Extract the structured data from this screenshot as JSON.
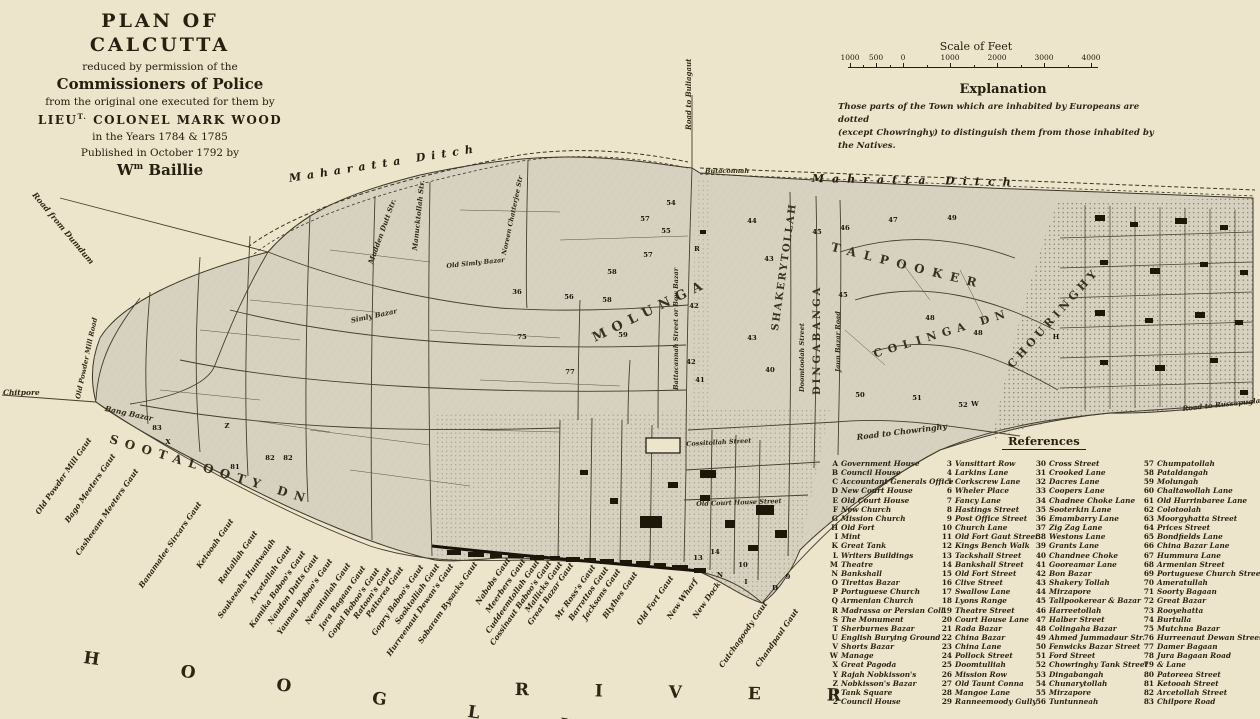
{
  "page": {
    "background": "#ece4cb",
    "ink": "#25200f",
    "land": "#d7d2c0",
    "building": "#1c1709"
  },
  "title_block": {
    "line1": "PLAN OF CALCUTTA",
    "line2": "reduced by permission of the",
    "line3": "Commissioners of Police",
    "line4": "from the original one executed for them by",
    "line5_pre": "LIEU",
    "line5_sup": "T.",
    "line5_post": " COLONEL MARK WOOD",
    "line6": "in the Years 1784 & 1785",
    "line7": "Published in October 1792 by",
    "line8_pre": "W",
    "line8_sup": "m",
    "line8_post": " Baillie"
  },
  "scale_bar": {
    "title": "Scale of Feet",
    "tick_labels": [
      "1000",
      "500",
      "0",
      "1000",
      "2000",
      "3000",
      "4000"
    ]
  },
  "explanation": {
    "heading": "Explanation",
    "line1": "Those parts of the Town which are inhabited by Europeans are dotted",
    "line2": "(except Chowringhy) to distinguish them from those inhabited by the Natives."
  },
  "references": {
    "heading": "References",
    "columns": [
      [
        [
          "A",
          "Government House"
        ],
        [
          "B",
          "Council House"
        ],
        [
          "C",
          "Accountant Generals Office"
        ],
        [
          "D",
          "New Court House"
        ],
        [
          "E",
          "Old Court House"
        ],
        [
          "F",
          "New Church"
        ],
        [
          "G",
          "Mission Church"
        ],
        [
          "H",
          "Old Fort"
        ],
        [
          "I",
          "Mint"
        ],
        [
          "K",
          "Great Tank"
        ],
        [
          "L",
          "Writers Buildings"
        ],
        [
          "M",
          "Theatre"
        ],
        [
          "N",
          "Bankshall"
        ],
        [
          "O",
          "Tirettas Bazar"
        ],
        [
          "P",
          "Portuguese Church"
        ],
        [
          "Q",
          "Armenian Church"
        ],
        [
          "R",
          "Madrassa or Persian Coll."
        ],
        [
          "S",
          "The Monument"
        ],
        [
          "T",
          "Sherburnes Bazar"
        ],
        [
          "U",
          "English Burying Ground"
        ],
        [
          "V",
          "Shorts Bazar"
        ],
        [
          "W",
          "Manage"
        ],
        [
          "X",
          "Great Pagoda"
        ],
        [
          "Y",
          "Rajah Nobkisson's"
        ],
        [
          "Z",
          "Nobkisson's Bazar"
        ],
        [
          "1",
          "Tank Square"
        ],
        [
          "2",
          "Council House"
        ]
      ],
      [
        [
          "3",
          "Vansittart Row"
        ],
        [
          "4",
          "Larkins Lane"
        ],
        [
          "5",
          "Corkscrew Lane"
        ],
        [
          "6",
          "Wheler Place"
        ],
        [
          "7",
          "Fancy Lane"
        ],
        [
          "8",
          "Hastings Street"
        ],
        [
          "9",
          "Post Office Street"
        ],
        [
          "10",
          "Church Lane"
        ],
        [
          "11",
          "Old Fort Gaut Street"
        ],
        [
          "12",
          "Kings Bench Walk"
        ],
        [
          "13",
          "Tackshall Street"
        ],
        [
          "14",
          "Bankshall Street"
        ],
        [
          "15",
          "Old Fort Street"
        ],
        [
          "16",
          "Clive Street"
        ],
        [
          "17",
          "Swallow Lane"
        ],
        [
          "18",
          "Lyons Range"
        ],
        [
          "19",
          "Theatre Street"
        ],
        [
          "20",
          "Court House Lane"
        ],
        [
          "21",
          "Rada Bazar"
        ],
        [
          "22",
          "China Bazar"
        ],
        [
          "23",
          "China Lane"
        ],
        [
          "24",
          "Pollock Street"
        ],
        [
          "25",
          "Doomtulliah"
        ],
        [
          "26",
          "Mission Row"
        ],
        [
          "27",
          "Old Taunt Conna"
        ],
        [
          "28",
          "Mangoe Lane"
        ],
        [
          "29",
          "Ranneemoody Gully"
        ]
      ],
      [
        [
          "30",
          "Cross Street"
        ],
        [
          "31",
          "Crooked Lane"
        ],
        [
          "32",
          "Dacres Lane"
        ],
        [
          "33",
          "Coopers Lane"
        ],
        [
          "34",
          "Chadnee Choke Lane"
        ],
        [
          "35",
          "Sooterkin Lane"
        ],
        [
          "36",
          "Emambarry Lane"
        ],
        [
          "37",
          "Zig Zag Lane"
        ],
        [
          "38",
          "Westons Lane"
        ],
        [
          "39",
          "Grants Lane"
        ],
        [
          "40",
          "Chandnee Choke"
        ],
        [
          "41",
          "Gooreamar Lane"
        ],
        [
          "42",
          "Bon Bazar"
        ],
        [
          "43",
          "Shakery Tollah"
        ],
        [
          "44",
          "Mirzapore"
        ],
        [
          "45",
          "Tallpookerear & Bazar"
        ],
        [
          "46",
          "Harreetollah"
        ],
        [
          "47",
          "Halber Street"
        ],
        [
          "48",
          "Colingaha Bazar"
        ],
        [
          "49",
          "Ahmed Jummadaur Str."
        ],
        [
          "50",
          "Fenwicks Bazar Street"
        ],
        [
          "51",
          "Ford Street"
        ],
        [
          "52",
          "Chowringhy Tank Street"
        ],
        [
          "53",
          "Dingabangah"
        ],
        [
          "54",
          "Chunarytollah"
        ],
        [
          "55",
          "Mirzapore"
        ],
        [
          "56",
          "Tuntunneah"
        ]
      ],
      [
        [
          "57",
          "Chumpatollah"
        ],
        [
          "58",
          "Pataldangah"
        ],
        [
          "59",
          "Molungah"
        ],
        [
          "60",
          "Chaltawollah Lane"
        ],
        [
          "61",
          "Old Hurrinbaree Lane"
        ],
        [
          "62",
          "Colotoolah"
        ],
        [
          "63",
          "Moorgyhatta Street"
        ],
        [
          "64",
          "Prices Street"
        ],
        [
          "65",
          "Bondfields Lane"
        ],
        [
          "66",
          "China Bazar Lane"
        ],
        [
          "67",
          "Hummura Lane"
        ],
        [
          "68",
          "Armenian Street"
        ],
        [
          "69",
          "Portuguese Church Street"
        ],
        [
          "70",
          "Ameratullah"
        ],
        [
          "71",
          "Soorty Bagaan"
        ],
        [
          "72",
          "Great Bazar"
        ],
        [
          "73",
          "Rooyehatta"
        ],
        [
          "74",
          "Burtulla"
        ],
        [
          "75",
          "Mutchna Bazar"
        ],
        [
          "76",
          "Hurreenaut Dewan Street"
        ],
        [
          "77",
          "Damer Bagaan"
        ],
        [
          "78",
          "Jura Bagaan Road"
        ],
        [
          "79",
          "& Lane"
        ],
        [
          "80",
          "Patoreea Street"
        ],
        [
          "81",
          "Ketooah Street"
        ],
        [
          "82",
          "Arcetollah Street"
        ],
        [
          "83",
          "Chilpore Road"
        ]
      ]
    ]
  },
  "map": {
    "region_labels": [
      {
        "text": "Maharatta Ditch",
        "x": 288,
        "y": 172,
        "rot": -9,
        "size": 11,
        "ls": 6,
        "kind": "ditch"
      },
      {
        "text": "Mahratta Ditch",
        "x": 812,
        "y": 172,
        "rot": 1,
        "size": 11,
        "ls": 8,
        "kind": "ditch"
      },
      {
        "text": "MOLUNGA",
        "x": 590,
        "y": 332,
        "rot": -26,
        "size": 13,
        "ls": 7,
        "kind": "region"
      },
      {
        "text": "SHAKERYTOLLAH",
        "x": 770,
        "y": 330,
        "rot": -82,
        "size": 10,
        "ls": 2,
        "kind": "region"
      },
      {
        "text": "DINGABANGA",
        "x": 812,
        "y": 395,
        "rot": -90,
        "size": 10,
        "ls": 3,
        "kind": "region"
      },
      {
        "text": "TALPOOKER",
        "x": 833,
        "y": 240,
        "rot": 14,
        "size": 12,
        "ls": 8,
        "kind": "region"
      },
      {
        "text": "COLINGA DN",
        "x": 872,
        "y": 348,
        "rot": -17,
        "size": 11,
        "ls": 6,
        "kind": "region"
      },
      {
        "text": "CHOURINGHY",
        "x": 1005,
        "y": 362,
        "rot": -48,
        "size": 11,
        "ls": 4,
        "kind": "region"
      },
      {
        "text": "SOOTALOOTY DN",
        "x": 112,
        "y": 432,
        "rot": 17,
        "size": 12,
        "ls": 7,
        "kind": "region"
      }
    ],
    "street_labels": [
      {
        "text": "Road to Buliagaut",
        "x": 684,
        "y": 130,
        "rot": -90,
        "size": 7
      },
      {
        "text": "Butaconnah",
        "x": 705,
        "y": 167,
        "rot": 0,
        "size": 6.5
      },
      {
        "text": "Road from Dumdum",
        "x": 38,
        "y": 190,
        "rot": 50,
        "size": 8
      },
      {
        "text": "Chitpore",
        "x": 3,
        "y": 388,
        "rot": 0,
        "size": 7.5
      },
      {
        "text": "Old Powder Mill Road",
        "x": 74,
        "y": 398,
        "rot": -78,
        "size": 6.8
      },
      {
        "text": "Bang Bazar",
        "x": 106,
        "y": 404,
        "rot": 12,
        "size": 7.5
      },
      {
        "text": "Mudden Dutt Str.",
        "x": 366,
        "y": 262,
        "rot": -70,
        "size": 7
      },
      {
        "text": "Manucktollah Str.",
        "x": 410,
        "y": 250,
        "rot": -84,
        "size": 7
      },
      {
        "text": "Old Simly Bazar",
        "x": 446,
        "y": 262,
        "rot": -6,
        "size": 6.5
      },
      {
        "text": "Simly Bazar",
        "x": 350,
        "y": 316,
        "rot": -12,
        "size": 7
      },
      {
        "text": "Noreen Chatterjee Str",
        "x": 500,
        "y": 254,
        "rot": -78,
        "size": 6.5
      },
      {
        "text": "Battacannah Street or Bow Bazar",
        "x": 672,
        "y": 390,
        "rot": -90,
        "size": 6.5
      },
      {
        "text": "Doomtoolah Street",
        "x": 798,
        "y": 392,
        "rot": -90,
        "size": 6.5
      },
      {
        "text": "Jaun Bazar Road",
        "x": 834,
        "y": 372,
        "rot": -90,
        "size": 6.5
      },
      {
        "text": "Cossitollah Street",
        "x": 686,
        "y": 440,
        "rot": -3,
        "size": 6.5
      },
      {
        "text": "Old Court House Street",
        "x": 696,
        "y": 500,
        "rot": -2,
        "size": 6.5
      },
      {
        "text": "Road to Chowringhy",
        "x": 856,
        "y": 432,
        "rot": -7,
        "size": 8
      },
      {
        "text": "Road to Russapuglah",
        "x": 1182,
        "y": 404,
        "rot": -6,
        "size": 7
      }
    ],
    "ghat_labels": [
      {
        "text": "Old Powder Mill Gaut",
        "x": 86,
        "y": 436
      },
      {
        "text": "Bago Meeters Gaut",
        "x": 110,
        "y": 452
      },
      {
        "text": "Casheeam Meeters Gaut",
        "x": 133,
        "y": 467
      },
      {
        "text": "Banamalee Sircars Gaut",
        "x": 196,
        "y": 500
      },
      {
        "text": "Ketooah Gaut",
        "x": 228,
        "y": 517
      },
      {
        "text": "Rottallah Gaut",
        "x": 252,
        "y": 529
      },
      {
        "text": "Soukeeahs Huntwalah",
        "x": 270,
        "y": 537
      },
      {
        "text": "Arcetollah Gaut",
        "x": 286,
        "y": 544
      },
      {
        "text": "Kamika Boboo's Gaut",
        "x": 300,
        "y": 549
      },
      {
        "text": "Naudon Dutts Gaut",
        "x": 313,
        "y": 553
      },
      {
        "text": "Yaunau Boboo's Gaut",
        "x": 327,
        "y": 557
      },
      {
        "text": "Neemtullah Gaut",
        "x": 345,
        "y": 561
      },
      {
        "text": "Jora Bagaan Gaut",
        "x": 360,
        "y": 564
      },
      {
        "text": "Gopal Boboo's Gaut",
        "x": 374,
        "y": 566
      },
      {
        "text": "Ratoon's Gaut",
        "x": 386,
        "y": 566
      },
      {
        "text": "Pattorea Gaut",
        "x": 398,
        "y": 565
      },
      {
        "text": "Gopry Baboo's Gaut",
        "x": 418,
        "y": 563
      },
      {
        "text": "Sooktolliah Gaut",
        "x": 434,
        "y": 562
      },
      {
        "text": "Hurreenaut Dewan's Gaut",
        "x": 448,
        "y": 562
      },
      {
        "text": "Sobaram Bysacks Gaut",
        "x": 472,
        "y": 560
      },
      {
        "text": "Nabobs Gaut",
        "x": 505,
        "y": 556
      },
      {
        "text": "Meerbers Gaut",
        "x": 520,
        "y": 557
      },
      {
        "text": "Cuddeemtollah Gaut",
        "x": 534,
        "y": 558
      },
      {
        "text": "Cossinaut Baboo's Gaut",
        "x": 546,
        "y": 559
      },
      {
        "text": "Mallicks Gaut",
        "x": 557,
        "y": 560
      },
      {
        "text": "Great Bazar Gaut",
        "x": 568,
        "y": 561
      },
      {
        "text": "Mr Ross's Gaut",
        "x": 590,
        "y": 563
      },
      {
        "text": "Barrettos Gaut",
        "x": 603,
        "y": 565
      },
      {
        "text": "Jacksons Gaut",
        "x": 615,
        "y": 567
      },
      {
        "text": "Blythes Gaut",
        "x": 632,
        "y": 570
      },
      {
        "text": "Old Fort Gaut",
        "x": 668,
        "y": 574
      },
      {
        "text": "New Wharf",
        "x": 692,
        "y": 577
      },
      {
        "text": "New Dock",
        "x": 715,
        "y": 580
      },
      {
        "text": "Cutchagoody Gaut",
        "x": 762,
        "y": 600
      },
      {
        "text": "Chandpaul Gaut",
        "x": 793,
        "y": 607
      }
    ],
    "river_label": {
      "word1": "H O O G L Y",
      "word2": "R I V E R"
    },
    "markers": [
      [
        "R",
        697,
        249
      ],
      [
        "54",
        671,
        203
      ],
      [
        "57",
        645,
        219
      ],
      [
        "55",
        666,
        231
      ],
      [
        "57",
        648,
        255
      ],
      [
        "58",
        612,
        272
      ],
      [
        "56",
        569,
        297
      ],
      [
        "58",
        607,
        300
      ],
      [
        "59",
        623,
        335
      ],
      [
        "42",
        694,
        306
      ],
      [
        "42",
        691,
        362
      ],
      [
        "43",
        769,
        259
      ],
      [
        "43",
        752,
        338
      ],
      [
        "44",
        752,
        221
      ],
      [
        "45",
        817,
        232
      ],
      [
        "45",
        843,
        295
      ],
      [
        "46",
        845,
        228
      ],
      [
        "47",
        893,
        220
      ],
      [
        "49",
        952,
        218
      ],
      [
        "48",
        930,
        318
      ],
      [
        "48",
        978,
        333
      ],
      [
        "50",
        860,
        395
      ],
      [
        "51",
        917,
        398
      ],
      [
        "52",
        963,
        405
      ],
      [
        "W",
        975,
        404
      ],
      [
        "36",
        517,
        292
      ],
      [
        "75",
        522,
        337
      ],
      [
        "77",
        570,
        372
      ],
      [
        "X",
        168,
        442
      ],
      [
        "Z",
        227,
        426
      ],
      [
        "83",
        157,
        428
      ],
      [
        "81",
        235,
        467
      ],
      [
        "82",
        270,
        458
      ],
      [
        "82",
        288,
        458
      ],
      [
        "H",
        1056,
        337
      ],
      [
        "N",
        720,
        575
      ],
      [
        "I",
        746,
        582
      ],
      [
        "D",
        775,
        588
      ],
      [
        "9",
        788,
        577
      ],
      [
        "10",
        743,
        565
      ],
      [
        "13",
        698,
        558
      ],
      [
        "14",
        715,
        552
      ],
      [
        "40",
        770,
        370
      ],
      [
        "41",
        700,
        380
      ]
    ]
  }
}
